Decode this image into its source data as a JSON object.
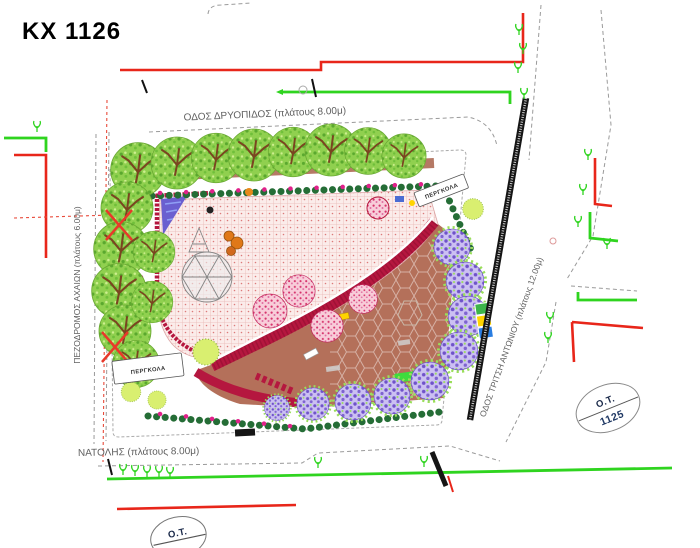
{
  "title": "ΚΧ 1126",
  "streets": {
    "top": "ΟΔΟΣ ΔΡΥΟΠΙΔΟΣ (πλάτους 8.00μ)",
    "left": "ΠΕΖΟΔΡΟΜΟΣ ΑΧΑΙΩΝ (πλάτους 6.00μ)",
    "right": "ΟΔΟΣ ΤΡΙΤΣΗ ΑΝΤΩΝΙΟΥ (πλάτους 12.00μ)",
    "bottom": "ΝΑΤΟΛΗΣ (πλάτους 8.00μ)"
  },
  "labels": {
    "pergola": "ΠΕΡΓΚΟΛΑ",
    "block_label": "Ο.Τ.",
    "block_number": "1125",
    "block_label_bottom": "Ο.Τ."
  },
  "colors": {
    "utility_red": "#e8261a",
    "utility_green": "#2fd41f",
    "canopy_green": "#90d04f",
    "hedge_green": "#256d36",
    "path_crimson": "#b5173f",
    "plaza_brown": "#b4705a",
    "playground_pink": "#fbecea",
    "flowering_purple": "#7e63cf",
    "lime_green": "#d9ef70",
    "street_edge_black": "#151515",
    "boundary_gray": "#9a9a9a",
    "marker_squares": [
      "#3cb54a",
      "#ffd400",
      "#2a7de1"
    ]
  }
}
